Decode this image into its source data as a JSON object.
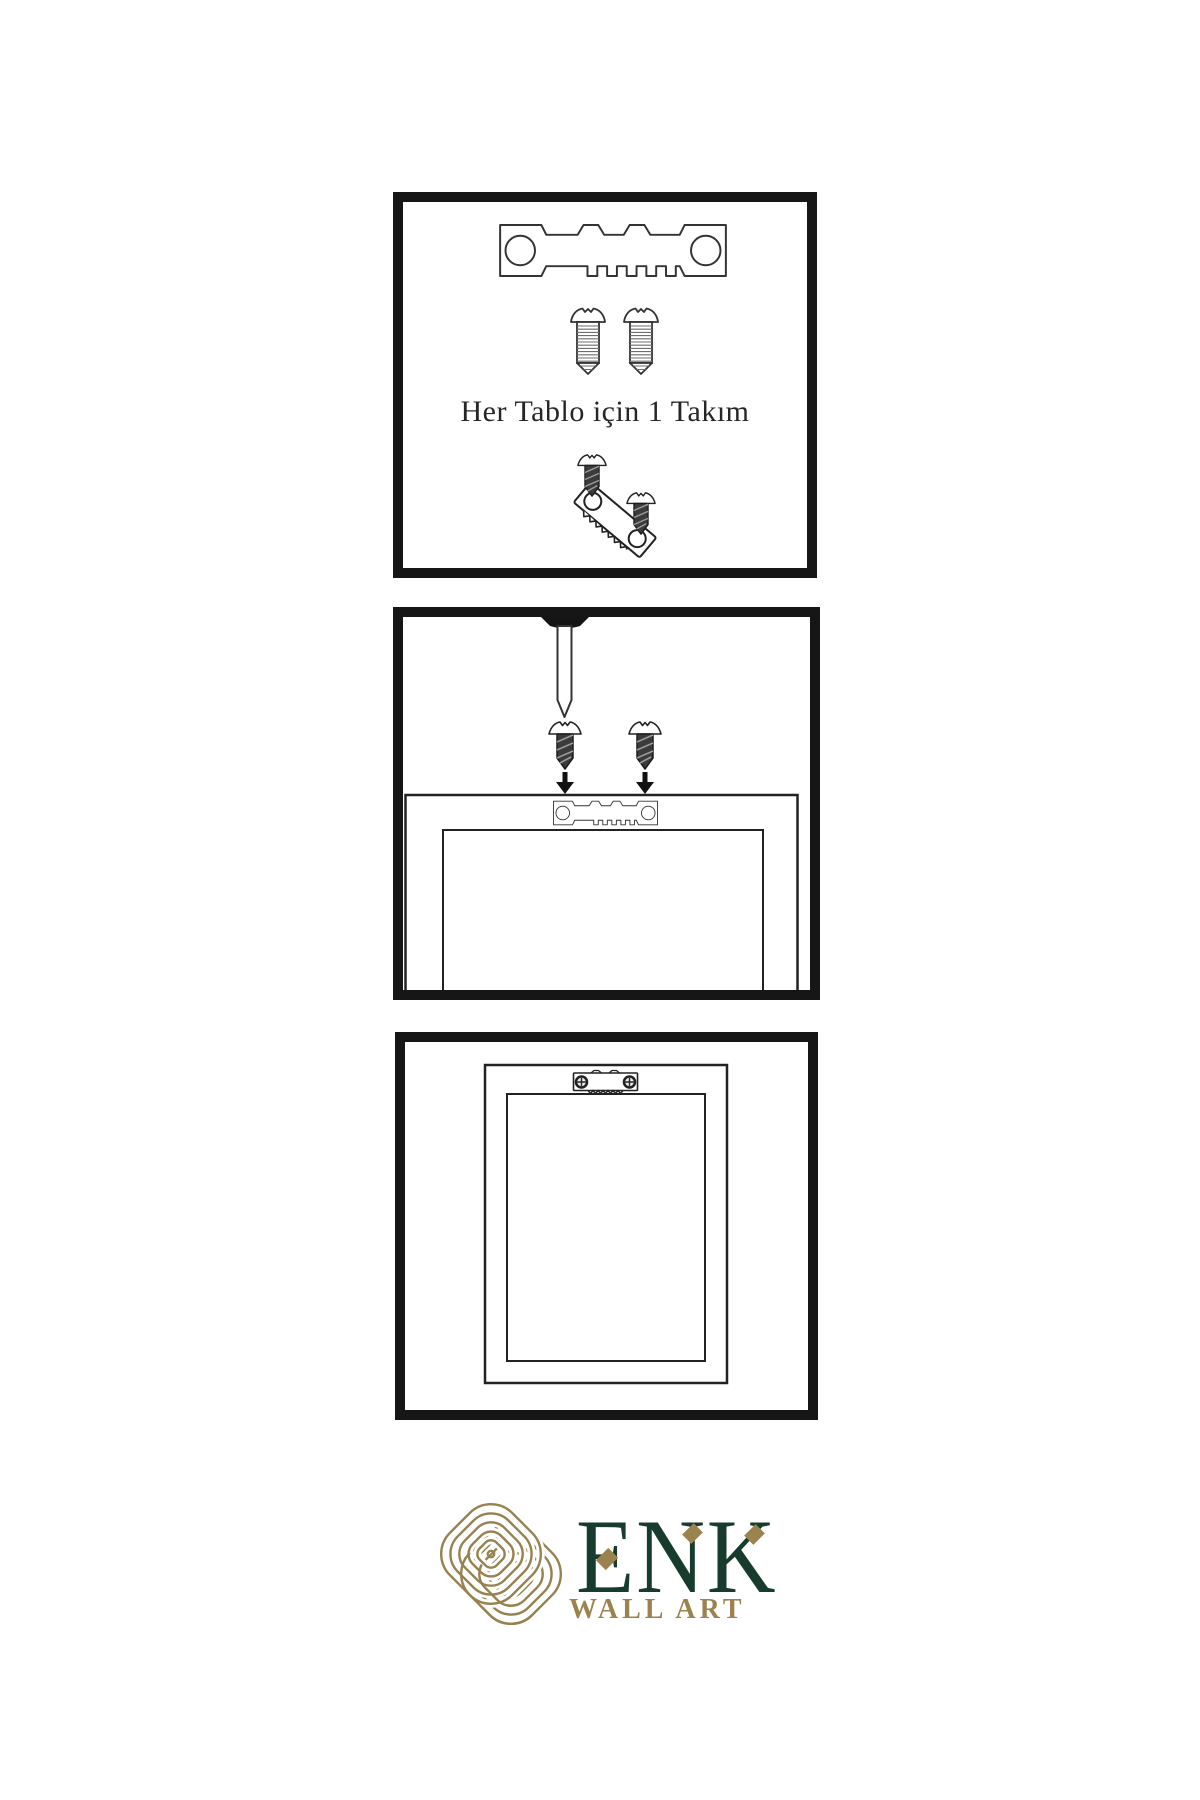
{
  "colors": {
    "background": "#ffffff",
    "panel_border": "#161616",
    "diagram_line": "#2b2b2b",
    "dark_hardware": "#3b3b3b",
    "logo_green": "#173b2d",
    "logo_gold": "#9b8350",
    "knot_gold": "#96824f"
  },
  "panels": {
    "step1_kit": {
      "caption": "Her Tablo için 1 Takım",
      "icons": [
        {
          "name": "sawtooth-hanger-icon"
        },
        {
          "name": "screw-icon"
        },
        {
          "name": "screw-icon"
        },
        {
          "name": "angled-hanger-with-screws-icon"
        }
      ]
    },
    "step2_mounting": {
      "icons": [
        {
          "name": "wall-nail-icon"
        },
        {
          "name": "dark-screw-icon"
        },
        {
          "name": "dark-screw-icon"
        },
        {
          "name": "arrow-down-icon"
        },
        {
          "name": "arrow-down-icon"
        },
        {
          "name": "frame-back-with-sawtooth-hanger-icon"
        }
      ]
    },
    "step3_hung_frame": {
      "icons": [
        {
          "name": "frame-back-with-mounted-hanger-icon"
        }
      ]
    }
  },
  "logo": {
    "icon": "knot-logo-icon",
    "brand": "ENK",
    "subtitle": "WALL ART"
  }
}
